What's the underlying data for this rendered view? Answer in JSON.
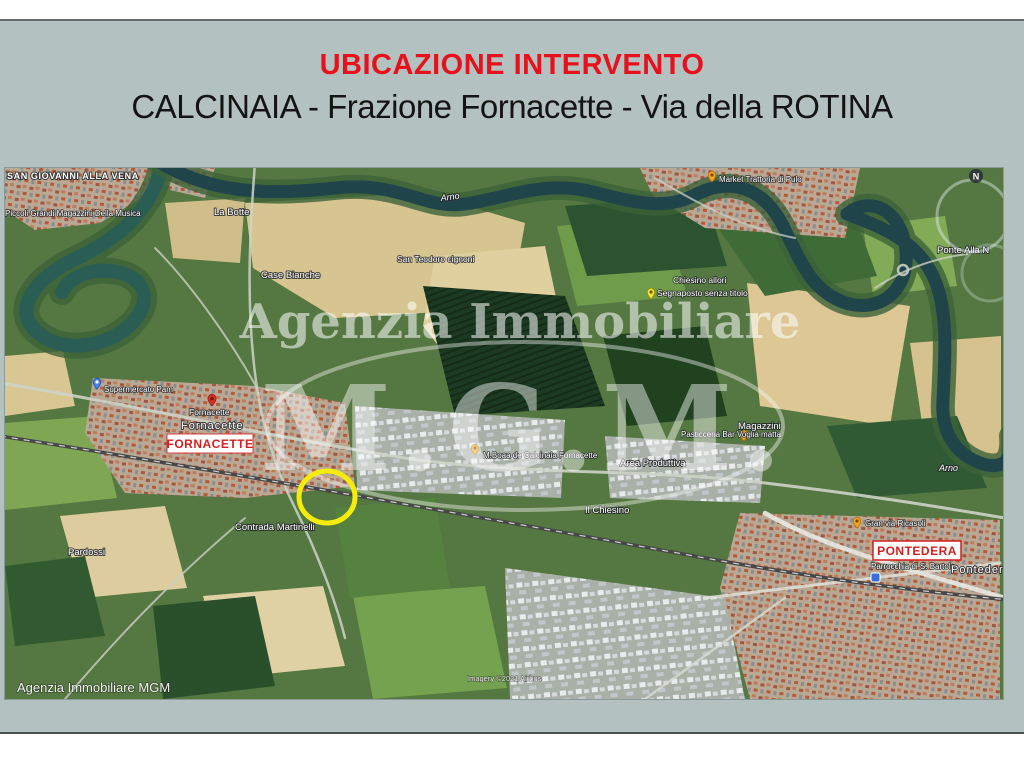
{
  "title": "UBICAZIONE INTERVENTO",
  "subtitle": "CALCINAIA - Frazione Fornacette - Via della ROTINA",
  "colors": {
    "title_red": "#e8101c",
    "callout_red": "#d31f1f",
    "slide_background": "#b3c2c0",
    "river_teal": "#1f454b",
    "marker_yellow": "#f6ec0a",
    "pin_orange": "#f5a623",
    "pin_red": "#d93025",
    "pin_blue": "#4285f4"
  },
  "map": {
    "place_labels": {
      "san_giovanni_alla_vena": "SAN GIOVANNI ALLA VENA",
      "magazzini_della_musica": "Piccoli Grandi Magazzini Della Musica",
      "la_botte": "La Botte",
      "arno_river_1": "Arno",
      "arno_river_2": "Arno",
      "san_teodoro": "San Teodoro cignoni",
      "case_bianche": "Case Bianche",
      "chiesino_allori": "Chiesino allori",
      "segnaposto_senza_titolo": "Segnaposto senza titolo",
      "ponte_alla_n": "Ponte Alla N",
      "trattoria_di_pulo": "Market Trattoria di Pulo",
      "fornacette_pin_label": "Fornacette",
      "fornacette_town_label": "Fornacette",
      "supermercato_pam": "Supermercato Pam",
      "calcinaia_store": "M.Boaa de Calcinaia Fornacette",
      "pasticceria_voglia_matta": "Pasticceria Bar Voglia matta",
      "magazzini": "Magazzini",
      "area_produttiva": "Area Produttiva",
      "il_chiesino": "Il Chiesino",
      "contrada_martinelli": "Contrada Martinelli",
      "pardossi": "Pardossi",
      "gran_via_ricasoli": "Gran via Ricasoli",
      "parrocchia": "Parrocchia di S. Bartolo",
      "pontedera_town_label": "Pontedera"
    },
    "callout_boxes": {
      "fornacette": "FORNACETTE",
      "pontedera": "PONTEDERA"
    },
    "watermark": {
      "line1": "Agenzia Immobiliare",
      "monogram": "M.G.M."
    },
    "compass_letter": "N",
    "credit": "Agenzia Immobiliare MGM",
    "imagery_attribution": "Imagery ©2021 Airbus"
  }
}
